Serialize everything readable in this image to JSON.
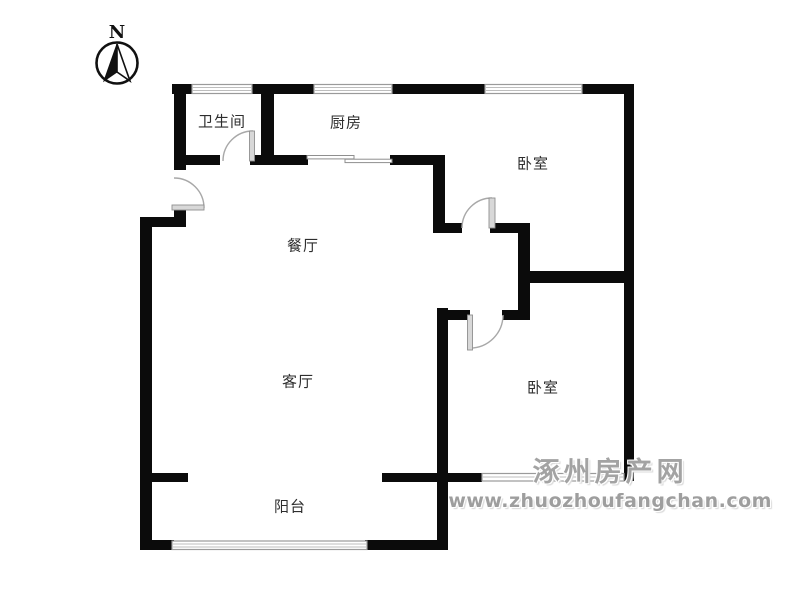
{
  "compass": {
    "label": "N"
  },
  "rooms": [
    {
      "id": "bathroom",
      "label": "卫生间",
      "x": 222,
      "y": 121
    },
    {
      "id": "kitchen",
      "label": "厨房",
      "x": 346,
      "y": 122
    },
    {
      "id": "bedroom-north",
      "label": "卧室",
      "x": 533,
      "y": 163
    },
    {
      "id": "dining",
      "label": "餐厅",
      "x": 303,
      "y": 245
    },
    {
      "id": "living",
      "label": "客厅",
      "x": 298,
      "y": 381
    },
    {
      "id": "bedroom-south",
      "label": "卧室",
      "x": 543,
      "y": 387
    },
    {
      "id": "balcony",
      "label": "阳台",
      "x": 290,
      "y": 506
    }
  ],
  "watermark": {
    "site_name": "涿州房产网",
    "site_url": "www.zhuozhoufangchan.com"
  },
  "colors": {
    "wall": "#0b0b0b",
    "door_arc": "#a8a8a8",
    "door_leaf": "#d8d8d8",
    "window_frame": "#9a9a9a",
    "label_text": "#2e2e2e",
    "watermark_gray": "#a3a3a3"
  }
}
